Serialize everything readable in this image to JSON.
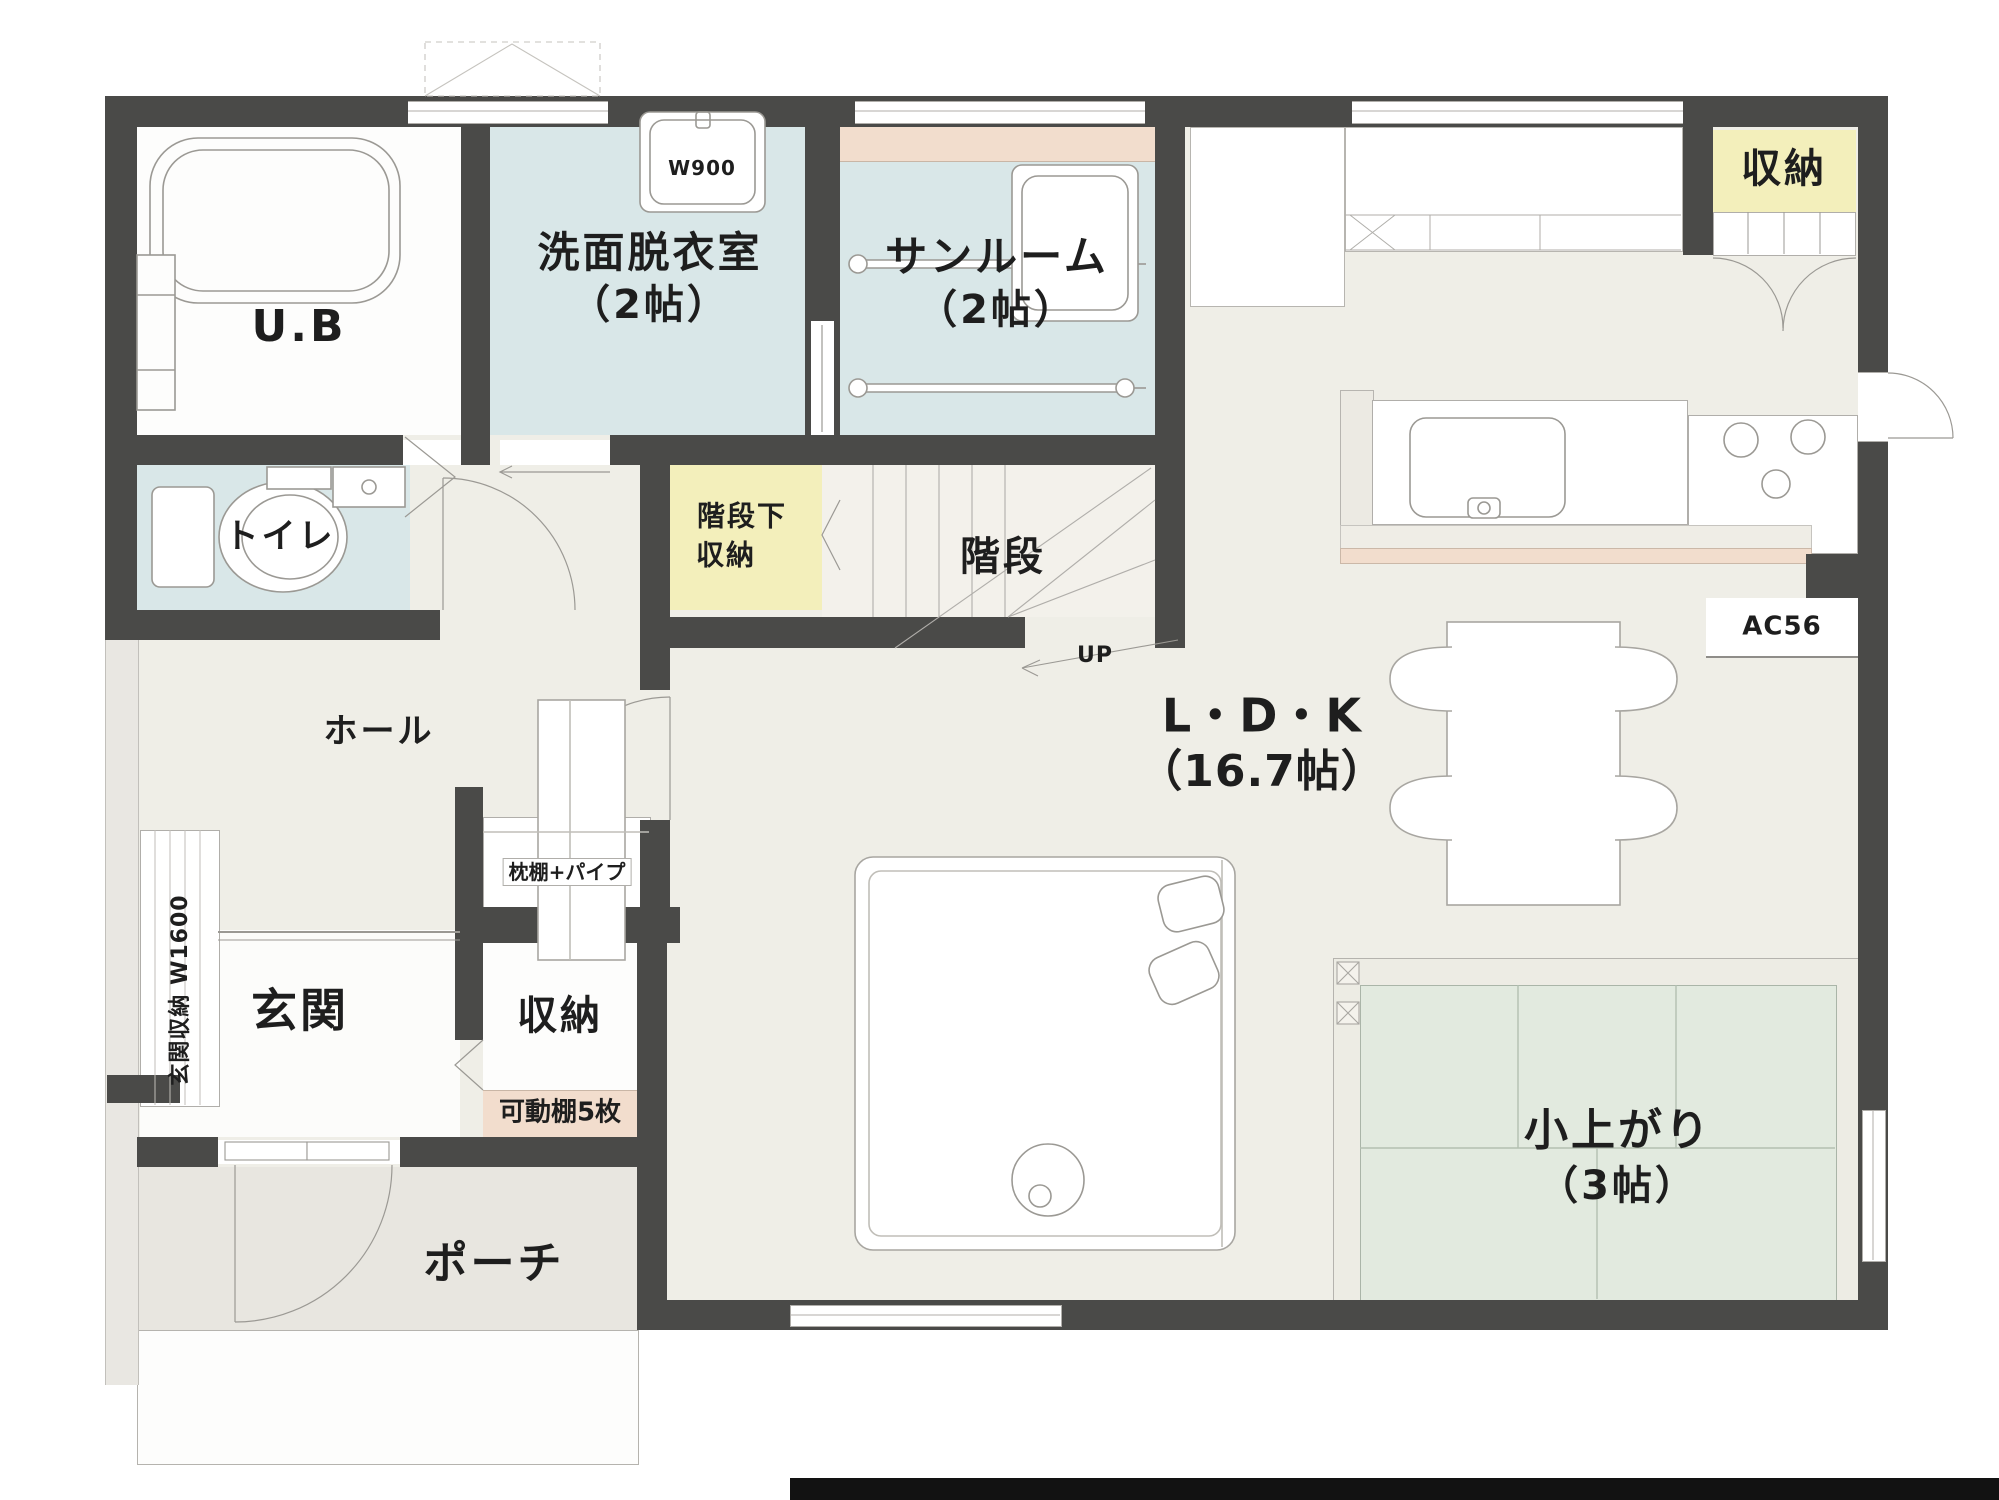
{
  "colors": {
    "wall": "#4a4a48",
    "wet_room_blue": "#d9e7e8",
    "storage_yellow": "#f3efbb",
    "shelf_peach": "#f2ddcd",
    "tatami_green": "#e2eadf",
    "floor_beige": "#efeee7",
    "porch_gray": "#e8e6e0",
    "line_gray": "#9b9994"
  },
  "labels": {
    "ub": "U.B",
    "w900": "W900",
    "senmen1": "洗面脱衣室",
    "senmen2": "（2帖）",
    "sunroom1": "サンルーム",
    "sunroom2": "（2帖）",
    "closet_tr": "収納",
    "toilet": "トイレ",
    "under_stairs1": "階段下",
    "under_stairs2": "収納",
    "stairs": "階段",
    "up": "UP",
    "ldk1": "L・D・K",
    "ldk2": "（16.7帖）",
    "ac": "AC56",
    "hall": "ホール",
    "genkan_closet": "玄関収納 W1600",
    "makuradana": "枕棚+パイプ",
    "genkan": "玄関",
    "entry_closet": "収納",
    "kadodana": "可動棚5枚",
    "porch": "ポーチ",
    "koagari1": "小上がり",
    "koagari2": "（3帖）"
  }
}
